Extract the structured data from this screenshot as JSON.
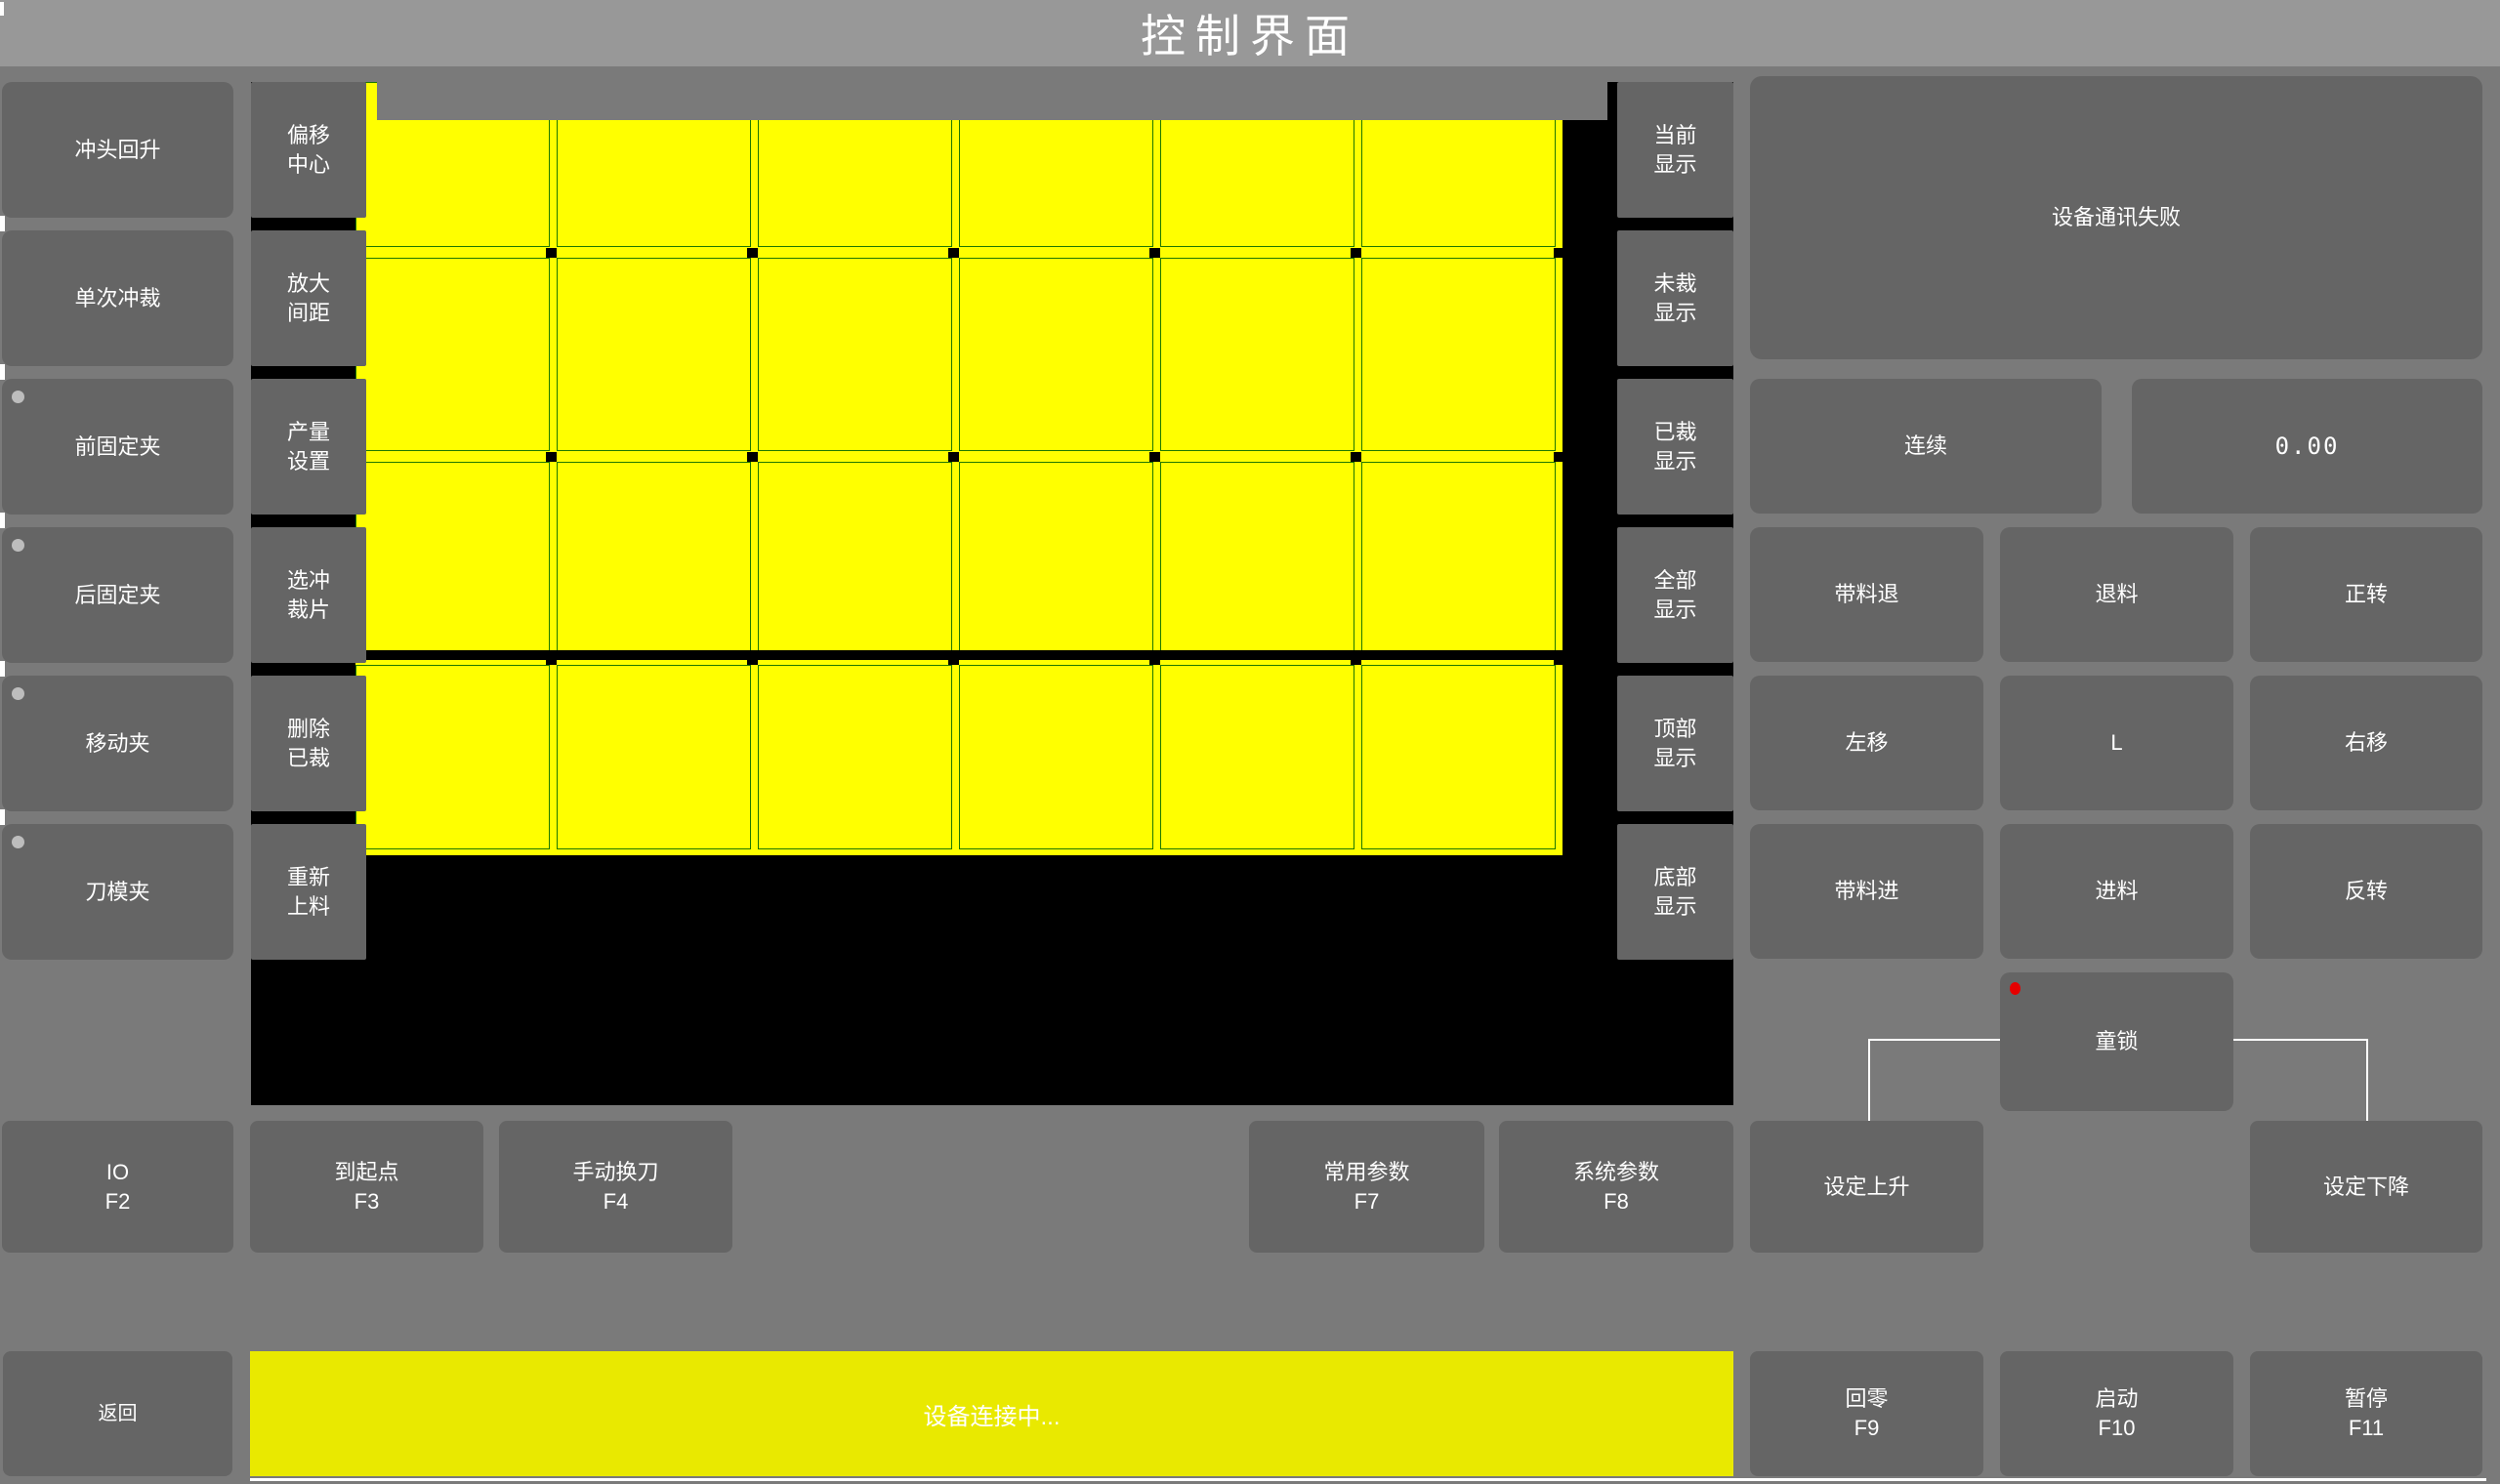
{
  "title": "控制界面",
  "colors": {
    "titlebar": "#989898",
    "background": "#7a7a7a",
    "button": "#656565",
    "canvas": "#000000",
    "sheet": "#ffff00",
    "grid_line": "#1e7800",
    "status_bar": "#e9e900",
    "alert_dot": "#e60000",
    "indicator_dot": "#bdbdbd"
  },
  "left_panel": {
    "buttons": [
      {
        "label": "冲头回升"
      },
      {
        "label": "单次冲裁"
      },
      {
        "label": "前固定夹"
      },
      {
        "label": "后固定夹"
      },
      {
        "label": "移动夹"
      },
      {
        "label": "刀模夹"
      }
    ]
  },
  "tool_panel": {
    "buttons": [
      {
        "line1": "偏移",
        "line2": "中心"
      },
      {
        "line1": "放大",
        "line2": "间距"
      },
      {
        "line1": "产量",
        "line2": "设置"
      },
      {
        "line1": "选冲",
        "line2": "裁片"
      },
      {
        "line1": "删除",
        "line2": "已裁"
      },
      {
        "line1": "重新",
        "line2": "上料"
      }
    ]
  },
  "display_panel": {
    "buttons": [
      {
        "line1": "当前",
        "line2": "显示"
      },
      {
        "line1": "未裁",
        "line2": "显示"
      },
      {
        "line1": "已裁",
        "line2": "显示"
      },
      {
        "line1": "全部",
        "line2": "显示"
      },
      {
        "line1": "顶部",
        "line2": "显示"
      },
      {
        "line1": "底部",
        "line2": "显示"
      }
    ]
  },
  "sheet": {
    "cols": 6,
    "rows": 4
  },
  "right_panel": {
    "message": "设备通讯失败",
    "mode": "连续",
    "value": "0.00",
    "jog": {
      "r1c1": "带料退",
      "r1c2": "退料",
      "r1c3": "正转",
      "r2c1": "左移",
      "r2c2": "L",
      "r2c3": "右移",
      "r3c1": "带料进",
      "r3c2": "进料",
      "r3c3": "反转"
    },
    "lock": "童锁"
  },
  "function_row": {
    "io": {
      "label": "IO",
      "key": "F2"
    },
    "origin": {
      "label": "到起点",
      "key": "F3"
    },
    "tool_change": {
      "label": "手动换刀",
      "key": "F4"
    },
    "common_params": {
      "label": "常用参数",
      "key": "F7"
    },
    "system_params": {
      "label": "系统参数",
      "key": "F8"
    },
    "set_rise": {
      "label": "设定上升"
    },
    "set_fall": {
      "label": "设定下降"
    }
  },
  "bottom_bar": {
    "back": "返回",
    "status": "设备连接中...",
    "home": {
      "label": "回零",
      "key": "F9"
    },
    "start": {
      "label": "启动",
      "key": "F10"
    },
    "pause": {
      "label": "暂停",
      "key": "F11"
    }
  }
}
